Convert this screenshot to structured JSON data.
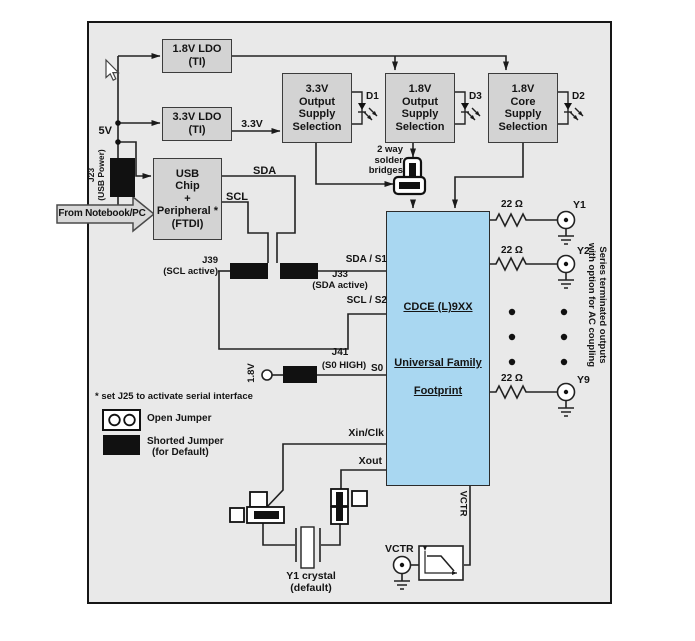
{
  "power": {
    "ldo_18": "1.8V LDO\n(TI)",
    "ldo_33": "3.3V LDO\n(TI)",
    "sel_33": "3.3V\nOutput\nSupply\nSelection",
    "sel_18_out": "1.8V\nOutput\nSupply\nSelection",
    "sel_18_core": "1.8V\nCore\nSupply\nSelection",
    "rail": "5V",
    "v33_net": "3.3V",
    "d1": "D1",
    "d2": "D2",
    "d3": "D3",
    "solder_bridges": "2 way\nsolder\nbridges"
  },
  "usb": {
    "chip": "USB\nChip\n+\nPeripheral *\n(FTDI)",
    "j23": "J23\n(USB Power)",
    "from_pc": "From Notebook/PC",
    "sda": "SDA",
    "scl": "SCL"
  },
  "serial": {
    "j39": "J39\n(SCL active)",
    "j33": "J33\n(SDA active)",
    "sda_s1": "SDA / S1",
    "scl_s2": "SCL / S2",
    "j41": "J41",
    "j41_sub": "(S0 HIGH)",
    "s0": "S0",
    "v18_net": "1.8V"
  },
  "chip": {
    "line1": "CDCE (L)9XX",
    "line2": "Universal Family",
    "line3": "Footprint",
    "fill": "#a9d7f1"
  },
  "outputs": {
    "r_value": "22 Ω",
    "y1": "Y1",
    "y2": "Y2",
    "y9": "Y9",
    "note": "Series terminated outputs\nwith option for AC coupling"
  },
  "xtal": {
    "xin": "Xin/Clk",
    "xout": "Xout",
    "label": "Y1 crystal\n(default)"
  },
  "vctr": {
    "pin": "VCTR",
    "connector": "VCTR"
  },
  "legend": {
    "note": "* set J25 to activate serial interface",
    "open_jumper": "Open Jumper",
    "shorted_jumper": "Shorted Jumper",
    "shorted_sub": "(for Default)"
  },
  "colors": {
    "panel": "#e9e9e9",
    "block_fill": "#d3d3d3",
    "chip_fill": "#a9d7f1",
    "jumper": "#111111",
    "wire": "#222222"
  }
}
